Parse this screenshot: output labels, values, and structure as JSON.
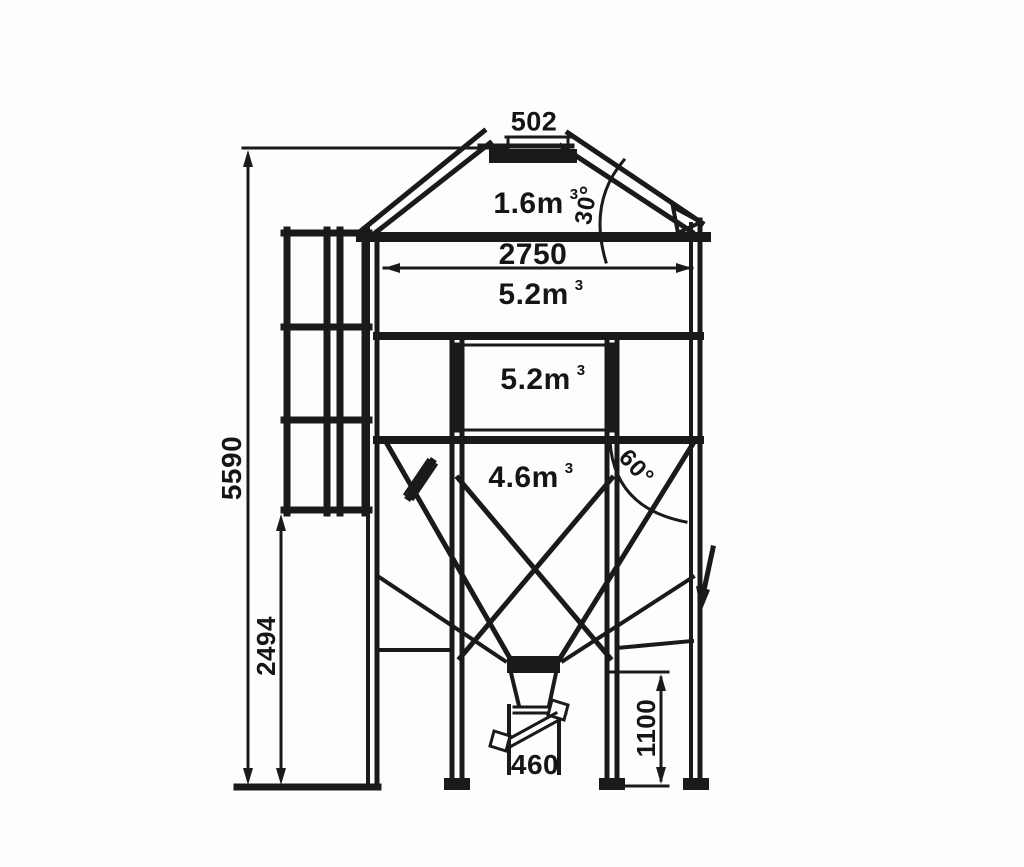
{
  "drawing": {
    "type": "technical-dimension-drawing",
    "subject": "hopper-silo-front-elevation",
    "background": "#fdfdfd",
    "line_color": "#1a1a1a",
    "dimensions": {
      "cap_width": "502",
      "body_width": "2750",
      "total_height": "5590",
      "stand_clearance": "2494",
      "outlet_clearance": "1100",
      "outlet_width": "460"
    },
    "angles": {
      "roof": "30°",
      "hopper": "60°"
    },
    "volumes": {
      "roof": {
        "value": "1.6m",
        "exp": "3"
      },
      "upper_ring": {
        "value": "5.2m",
        "exp": "3"
      },
      "lower_ring": {
        "value": "5.2m",
        "exp": "3"
      },
      "hopper": {
        "value": "4.6m",
        "exp": "3"
      }
    }
  }
}
